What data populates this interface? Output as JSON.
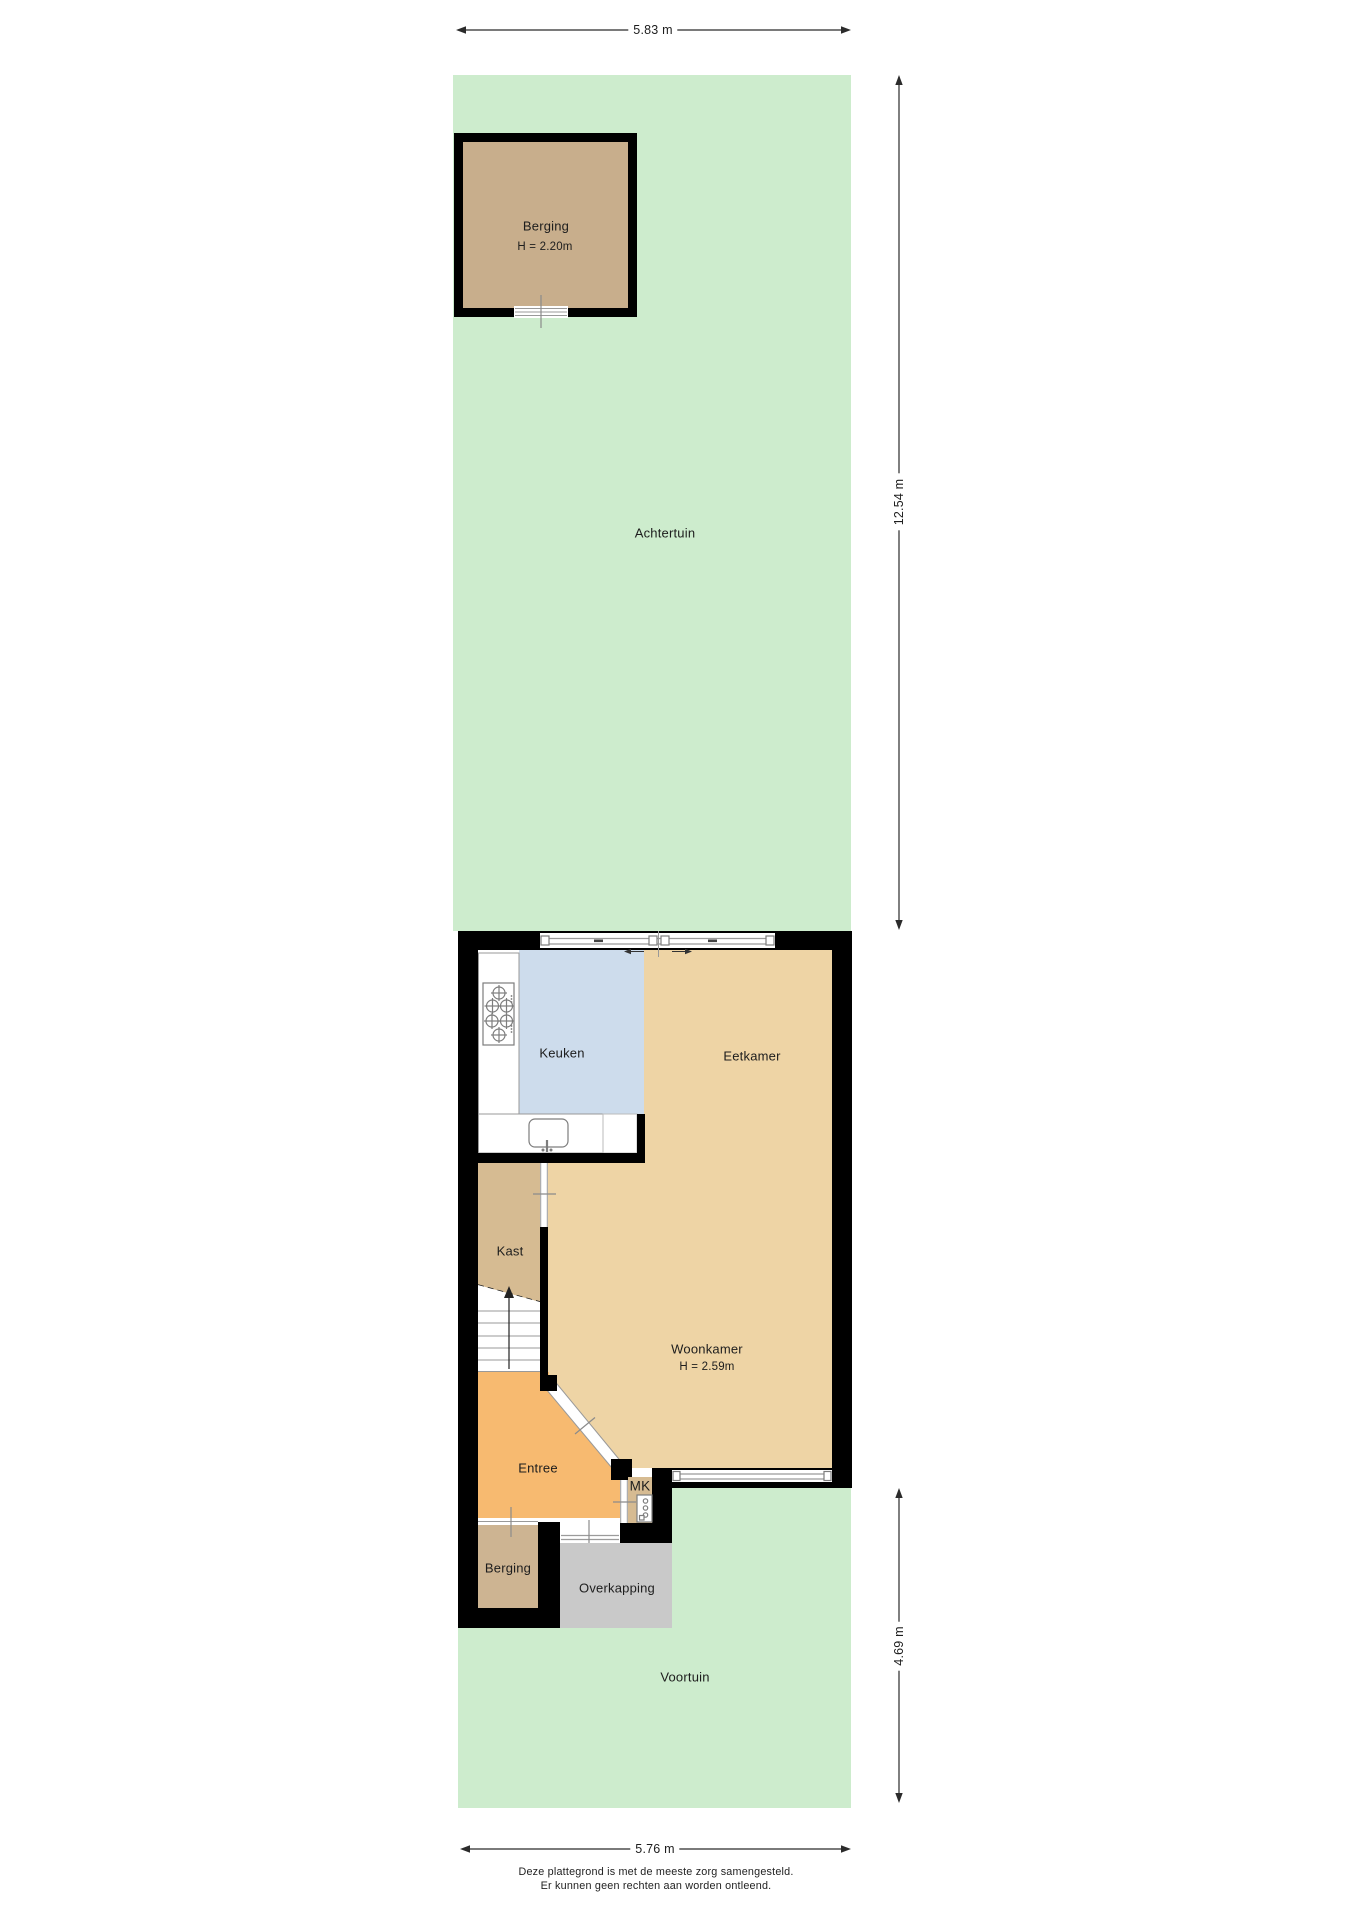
{
  "rooms": {
    "achtertuin": {
      "label": "Achtertuin"
    },
    "berging_tuin": {
      "label": "Berging",
      "height": "H = 2.20m"
    },
    "keuken": {
      "label": "Keuken"
    },
    "eetkamer": {
      "label": "Eetkamer"
    },
    "kast": {
      "label": "Kast"
    },
    "woonkamer": {
      "label": "Woonkamer",
      "height": "H = 2.59m"
    },
    "entree": {
      "label": "Entree"
    },
    "mk": {
      "label": "MK"
    },
    "berging_voor": {
      "label": "Berging"
    },
    "overkapping": {
      "label": "Overkapping"
    },
    "voortuin": {
      "label": "Voortuin"
    }
  },
  "dimensions": {
    "plot_width_back": "5.83 m",
    "garden_back_depth": "12.54 m",
    "garden_front_depth": "4.69 m",
    "plot_width_front": "5.76 m"
  },
  "footer": {
    "line1": "Deze plattegrond is met de meeste zorg samengesteld.",
    "line2": "Er kunnen geen rechten aan worden ontleend."
  },
  "colors": {
    "garden_green": "#cdeccd",
    "room_tan": "#eed4a5",
    "kast_tan": "#d6bb92",
    "shed_tan": "#c8ae8c",
    "storage_tan": "#cdb492",
    "entree_orange": "#f7ba70",
    "kitchen_blue": "#cddcec",
    "canopy_gray": "#c9c9c9",
    "wall_black": "#000000"
  }
}
